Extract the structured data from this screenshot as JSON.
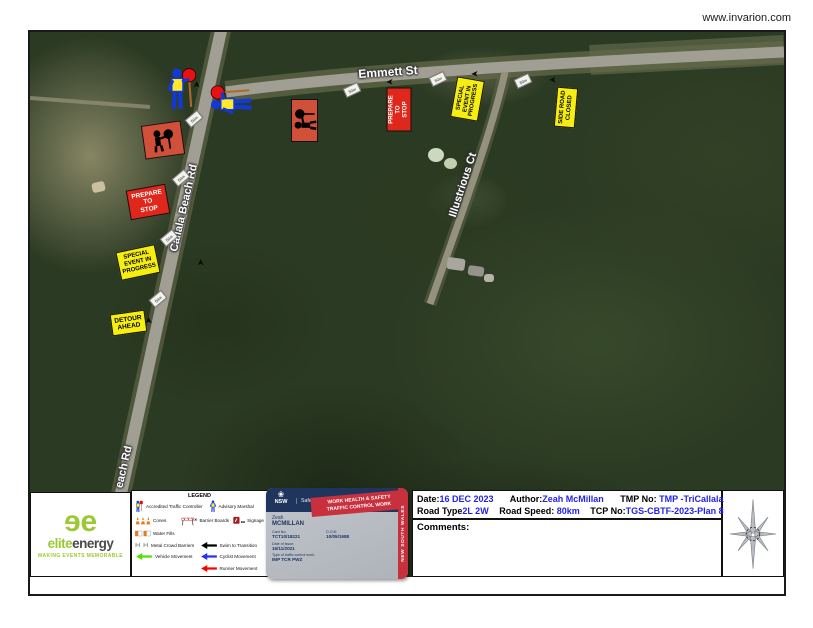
{
  "watermark": "www.invarion.com",
  "map": {
    "road_labels": {
      "emmett": "Emmett St",
      "callala": "Callala Beach Rd",
      "callala_partial": "each Rd",
      "illustrious": "Illustrious Ct"
    },
    "signs": {
      "prepare_to_stop_1": "PREPARE\nTO\nSTOP",
      "prepare_to_stop_2": "PREPARE\nTO\nSTOP",
      "special_event_1": "SPECIAL\nEVENT IN\nPROGRESS",
      "special_event_2": "SPECIAL\nEVENT IN\nPROGRESS",
      "detour_ahead": "DETOUR\nAHEAD",
      "side_road_closed": "SIDE ROAD\nCLOSED"
    },
    "distance_marker": "50m"
  },
  "logo": {
    "brand_elite": "elite",
    "brand_energy": "energy",
    "tagline": "MAKING EVENTS MEMORABLE"
  },
  "legend": {
    "title": "LEGEND",
    "items": [
      {
        "label": "Accredited Traffic Controller",
        "icon": "traffic-controller-icon"
      },
      {
        "label": "Advisory Marshal",
        "icon": "advisory-marshal-icon"
      },
      {
        "label": "Cones",
        "icon": "cones-icon"
      },
      {
        "label": "Barrier Boards",
        "icon": "barrier-boards-icon"
      },
      {
        "label": "Signage",
        "icon": "signage-icon"
      },
      {
        "label": "Water Fills",
        "icon": "water-fills-icon"
      },
      {
        "label": "Metal Crowd Barriers",
        "icon": "metal-crowd-barriers-icon"
      },
      {
        "label": "Swim to Transition",
        "icon": "black-arrow-icon",
        "color": "#000000"
      },
      {
        "label": "Vehicle Movement",
        "icon": "green-arrow-icon",
        "color": "#55dd00"
      },
      {
        "label": "Cyclist Movement",
        "icon": "blue-arrow-icon",
        "color": "#2233ff"
      },
      {
        "label": "Runner Movement",
        "icon": "red-arrow-icon",
        "color": "#ff0000"
      }
    ]
  },
  "card": {
    "nsw": "NSW",
    "agency": "SafeWork NSW",
    "title": "WORK HEALTH & SAFETY",
    "title2": "TRAFFIC CONTROL WORK",
    "side_band": "NEW SOUTH WALES",
    "first_name": "Zeah",
    "surname": "MCMILLAN",
    "card_no_label": "Card No:",
    "card_no": "TCT10/18221",
    "dob_label": "D.O.B:",
    "dob": "10/05/1988",
    "issue_label": "Date of Issue:",
    "issue": "16/11/2021",
    "type_label": "Type of traffic control work:",
    "type": "IMP  TCR  PWZ"
  },
  "info": {
    "date_label": "Date:",
    "date": "16 DEC 2023",
    "author_label": "Author:",
    "author": "Zeah McMillan",
    "tmp_label": "TMP No:",
    "tmp": "TMP -TriCallala",
    "road_type_label": "Road Type",
    "road_type": "2L 2W",
    "road_speed_label": "Road Speed:",
    "road_speed": "80km",
    "tcp_label": "TCP No:",
    "tcp": "TGS-CBTF-2023-Plan 8",
    "comments_label": "Comments:"
  },
  "colors": {
    "sign_red": "#e0271c",
    "sign_yellow": "#f6ee10",
    "symbolic_sign_salmon": "#d0503a",
    "info_value_blue": "#2222e8",
    "card_red": "#c8303e",
    "card_navy": "#20355e",
    "logo_green": "#9bc934"
  }
}
